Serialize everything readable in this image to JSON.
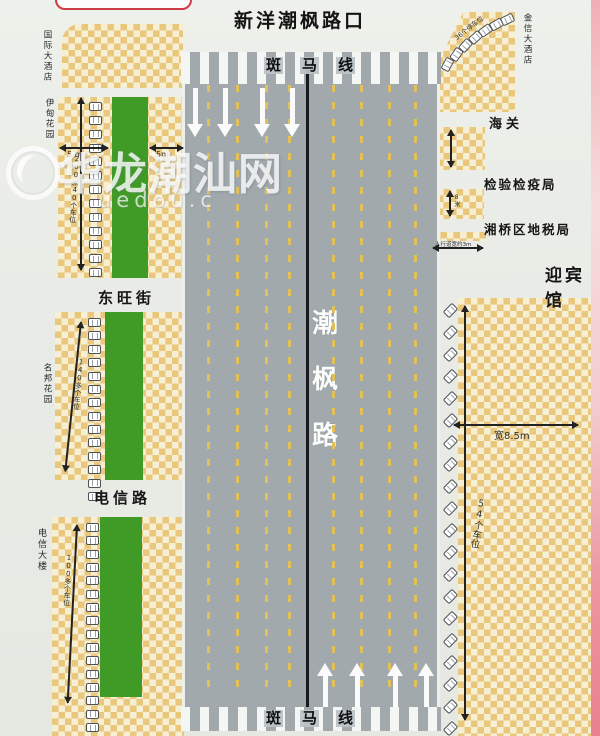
{
  "title": "新洋潮枫路口",
  "watermark": {
    "site_name": "华龙潮汕网",
    "latin": "uedou.c"
  },
  "road": {
    "name": "潮枫路",
    "chars": [
      "潮",
      "枫",
      "路"
    ],
    "zebra": [
      "斑",
      "马",
      "线"
    ]
  },
  "left": {
    "buildings": [
      "国际大酒店",
      "伊甸花园",
      "名邦花园",
      "电信大楼"
    ],
    "streets": [
      "东旺街",
      "电信路"
    ],
    "dims": {
      "gap_left": "5 m",
      "gap_right": "5m",
      "strip1": "200米40个车位",
      "strip2": "140多个车位",
      "strip3": "100多个车位"
    }
  },
  "right": {
    "hotel": "金信大酒店",
    "customs": "海关",
    "quarantine": "检验检疫局",
    "tax_bureau": "湘桥区地税局",
    "guesthouse": "迎宾馆",
    "dims": {
      "corner_spots": "36个停车位",
      "block_height": "8米",
      "sidewalk": "人行道宽约3m",
      "width": "宽8.5m",
      "spots": "54个车位"
    }
  }
}
